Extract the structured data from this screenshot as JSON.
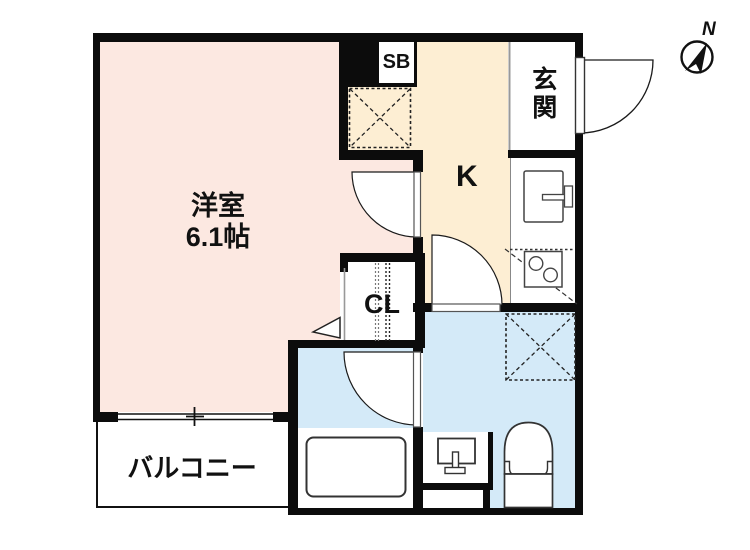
{
  "plan": {
    "rooms": {
      "western_room": {
        "name": "洋室",
        "size": "6.1帖"
      },
      "kitchen": {
        "name": "K"
      },
      "entrance": {
        "name": "玄関"
      },
      "closet": {
        "name": "CL"
      },
      "shoe_box": {
        "name": "SB"
      },
      "balcony": {
        "name": "バルコニー"
      }
    },
    "compass": {
      "north_label": "N"
    },
    "fixtures": [
      "refrigerator-space",
      "kitchen-sink",
      "gas-stove",
      "washing-machine-space",
      "washbasin",
      "toilet",
      "bathtub",
      "sliding-window",
      "entrance-door",
      "room-door",
      "washroom-door",
      "bath-door",
      "closet-door-indicator"
    ],
    "colors": {
      "western_room_fill": "#fce8e1",
      "kitchen_fill": "#fdeed3",
      "wet_area_fill": "#d4eaf8",
      "wall": "#0c0c0c"
    }
  }
}
